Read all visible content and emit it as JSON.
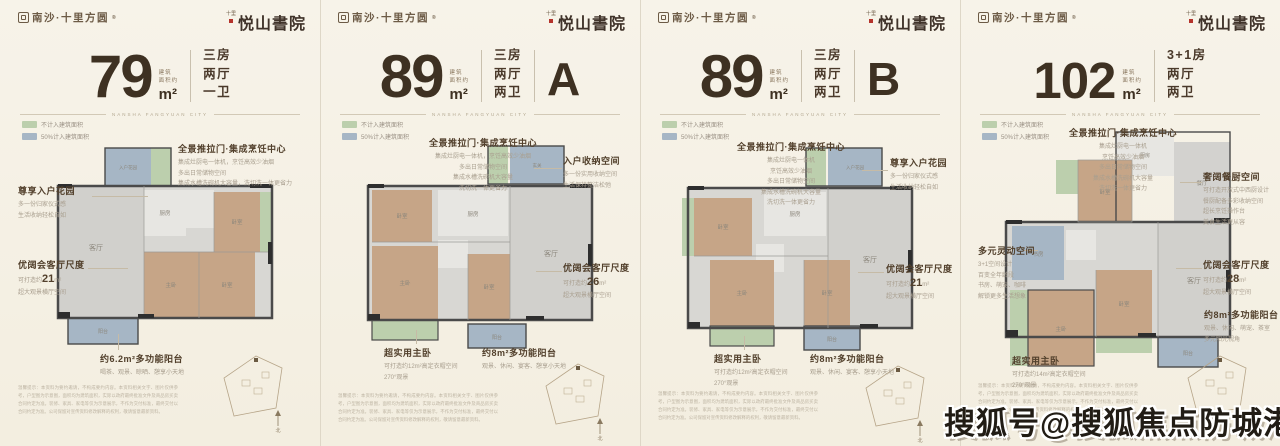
{
  "brand": {
    "left_logo": "南沙·十里方圆",
    "left_logo_reg": "®",
    "right_logo": "悦山書院",
    "right_logo_prefix": "十里",
    "divider_caption": "NANSHA FANGYUAN CITY"
  },
  "legend": {
    "green": "不计入建筑面积",
    "blue": "50%计入建筑面积"
  },
  "rooms": {
    "living": "客厅",
    "dining": "餐厅",
    "master": "主卧",
    "bedroom": "卧室",
    "kitchen": "厨房",
    "bath": "卫生间",
    "balcony": "阳台",
    "garden": "入户花园",
    "hall": "玄关",
    "study": "书房"
  },
  "site": {
    "north_label": "北"
  },
  "watermark": "搜狐号@搜狐焦点防城港站",
  "footer_disclaimer": "温馨提示：本资料为要约邀请，不构成要约内容。本资料相关文字、图片仅供参考，户型图为示意图，面积均为建筑面积，实际以政府最终批准文件及商品房买卖合同约定为准。装修、家具、家电等仅为示意展示，不作为交付标准，最终交付以合同约定为准。公司保留对宣传资料修改解释的权利，敬请留意最新资料。",
  "cards": [
    {
      "area": "79",
      "area_note_1": "建筑",
      "area_note_2": "面积约",
      "unit": "m²",
      "layout_lines": "三房\n两厅\n一卫",
      "type_letter": "",
      "callouts": {
        "kitchen": {
          "title": "全景推拉门·集成烹饪中心",
          "lines": "集成灶厨电一体机，烹饪高效少油烟\n多出日常储物空间\n集成水槽洗碗机大容量，洗切洗一体更省力"
        },
        "garden": {
          "title": "尊享入户花园",
          "lines": "多一份归家仪式感\n生活收纳轻松自如"
        },
        "living": {
          "title": "优阔会客厅尺度",
          "prefix": "可打造约",
          "value": "21",
          "vunit": "m²",
          "lines": "超大观景横厅空间"
        },
        "balcony": {
          "title": "约6.2m²多功能阳台",
          "lines": "喝茶、观景、晾晒、憩享小天地"
        }
      }
    },
    {
      "area": "89",
      "area_note_1": "建筑",
      "area_note_2": "面积约",
      "unit": "m²",
      "layout_lines": "三房\n两厅\n两卫",
      "type_letter": "A",
      "callouts": {
        "kitchen": {
          "title": "全景推拉门·集成烹饪中心",
          "lines": "集成灶厨电一体机，烹饪高效少油烟\n多出日常储物空间\n集成水槽洗碗机大容量\n洗切洗一体更省力"
        },
        "storage": {
          "title": "入户收纳空间",
          "lines": "多一份实用收纳空间\n生活保持整洁松弛"
        },
        "living": {
          "title": "优阔会客厅尺度",
          "prefix": "可打造约",
          "value": "26",
          "vunit": "m²",
          "lines": "超大观景横厅空间"
        },
        "master": {
          "title": "超实用主卧",
          "lines": "可打造约12m²高定衣帽空间\n270°观景"
        },
        "balcony": {
          "title": "约8m²多功能阳台",
          "lines": "观景、休闲、宴客、憩享小天地"
        }
      }
    },
    {
      "area": "89",
      "area_note_1": "建筑",
      "area_note_2": "面积约",
      "unit": "m²",
      "layout_lines": "三房\n两厅\n两卫",
      "type_letter": "B",
      "callouts": {
        "kitchen": {
          "title": "全景推拉门·集成烹饪中心",
          "lines": "集成灶厨电一体机\n烹饪高效少油烟\n多出日常储物空间\n集成水槽洗碗机大容量\n洗切洗一体更省力"
        },
        "garden": {
          "title": "尊享入户花园",
          "lines": "多一份归家仪式感\n生活收纳轻松自如"
        },
        "living": {
          "title": "优阔会客厅尺度",
          "prefix": "可打造约",
          "value": "21",
          "vunit": "m²",
          "lines": "超大观景横厅空间"
        },
        "master": {
          "title": "超实用主卧",
          "lines": "可打造约12m²高定衣帽空间\n270°观景"
        },
        "balcony": {
          "title": "约8m²多功能阳台",
          "lines": "观景、休闲、宴客、憩享小天地"
        }
      }
    },
    {
      "area": "102",
      "area_note_1": "建筑",
      "area_note_2": "面积约",
      "unit": "m²",
      "layout_lines": "3+1房\n两厅\n两卫",
      "type_letter": "",
      "callouts": {
        "kitchen": {
          "title": "全景推拉门·集成烹饪中心",
          "lines": "集成灶厨电一体机\n烹饪高效少油烟\n多出日常储物空间\n集成水槽洗碗机大容量\n洗切洗一体更省力"
        },
        "dining": {
          "title": "奢阔餐厨空间",
          "lines": "可打造开放式中西厨设计\n餐厨配备多彩收纳空间\n超长烹饪操作台\n美食生活更从容"
        },
        "flex": {
          "title": "多元灵动空间",
          "lines": "3+1空间设计\n百变全年龄段\n书房、萌宠、咖啡\n解锁更多生活想象"
        },
        "living": {
          "title": "优阔会客厅尺度",
          "prefix": "可打造约",
          "value": "28",
          "vunit": "m²",
          "lines": "超大观景横厅空间"
        },
        "balcony": {
          "title": "约8m²多功能阳台",
          "lines": "观景、休闲、萌宠、茶室\n多元阳光视角"
        },
        "master": {
          "title": "超实用主卧",
          "lines": "可打造约14m²高定衣帽空间\n270°观景"
        }
      }
    }
  ]
}
